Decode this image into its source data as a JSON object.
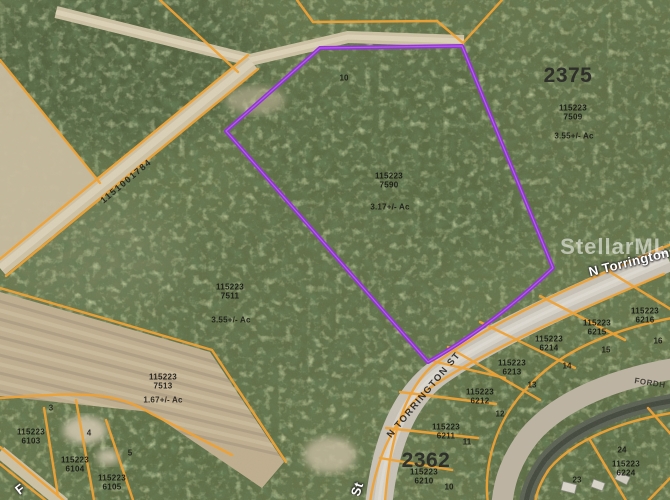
{
  "map": {
    "watermark": "StellarMLS",
    "colors": {
      "parcel_line": "#F0A233",
      "subject_outline": "#9333D6",
      "vegetation_base": "#68754C",
      "dirt_road": "#CDC1A4",
      "paved_road": "#C6C0B5"
    },
    "blocks": {
      "b2375": "2375",
      "b2362": "2362"
    },
    "streets": {
      "n_torrington_overlay": "N Torrington",
      "n_torrington_st": "N TORRINGTON ST",
      "fordham_partial": "FORDH",
      "st_partial": "St",
      "sw_partial": "F",
      "road_id": "1151001784"
    },
    "parcels": {
      "p7509": {
        "l1": "115223",
        "l2": "7509",
        "ac": "3.55+/- Ac"
      },
      "p7590": {
        "l1": "115223",
        "l2": "7590",
        "ac": "3.17+/- Ac"
      },
      "p7511": {
        "l1": "115223",
        "l2": "7511",
        "ac": "3.55+/- Ac"
      },
      "p7513": {
        "l1": "115223",
        "l2": "7513",
        "ac": "1.67+/- Ac"
      },
      "p6103": {
        "l1": "115223",
        "l2": "6103"
      },
      "p6104": {
        "l1": "115223",
        "l2": "6104"
      },
      "p6105": {
        "l1": "115223",
        "l2": "6105"
      },
      "p6210": {
        "l1": "115223",
        "l2": "6210"
      },
      "p6211": {
        "l1": "115223",
        "l2": "6211"
      },
      "p6212": {
        "l1": "115223",
        "l2": "6212"
      },
      "p6213": {
        "l1": "115223",
        "l2": "6213"
      },
      "p6214": {
        "l1": "115223",
        "l2": "6214"
      },
      "p6215": {
        "l1": "115223",
        "l2": "6215"
      },
      "p6216": {
        "l1": "115223",
        "l2": "6216"
      },
      "p6224": {
        "l1": "115223",
        "l2": "6224"
      }
    },
    "lots": {
      "purple_area": "10",
      "lot3": "3",
      "lot4": "4",
      "lot5": "5",
      "lot10": "10",
      "lot11": "11",
      "lot12": "12",
      "lot13": "13",
      "lot14": "14",
      "lot15": "15",
      "lot16": "16",
      "lot23": "23",
      "lot24": "24"
    }
  }
}
